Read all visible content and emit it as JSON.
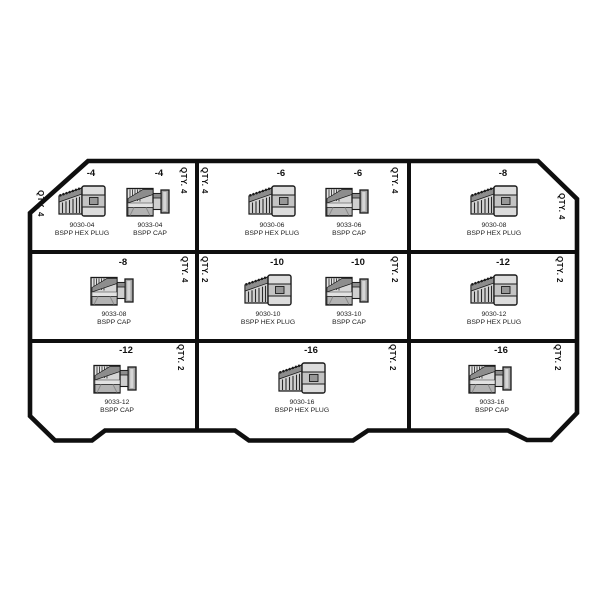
{
  "diagram": {
    "description": "BSPP hex plug and cap kit compartment layout",
    "line_color": "#0f0f0f",
    "background_color": "#ffffff",
    "fill_grays": [
      "#8d8d8d",
      "#b3b3b3",
      "#cfcfcf",
      "#d6d6d6",
      "#e2e2e2"
    ],
    "cells": [
      {
        "position": "row1-col1",
        "qty_left": "QTY. 4",
        "qty_right": "QTY. 4",
        "items": [
          {
            "size": "-4",
            "part": "9030-04",
            "name": "BSPP HEX PLUG",
            "type": "hex plug"
          },
          {
            "size": "-4",
            "part": "9033-04",
            "name": "BSPP CAP",
            "type": "cap"
          }
        ]
      },
      {
        "position": "row1-col2",
        "qty_left": "QTY. 4",
        "qty_right": "QTY. 4",
        "items": [
          {
            "size": "-6",
            "part": "9030-06",
            "name": "BSPP HEX PLUG",
            "type": "hex plug"
          },
          {
            "size": "-6",
            "part": "9033-06",
            "name": "BSPP CAP",
            "type": "cap"
          }
        ]
      },
      {
        "position": "row1-col3",
        "qty_right": "QTY. 4",
        "items": [
          {
            "size": "-8",
            "part": "9030-08",
            "name": "BSPP HEX PLUG",
            "type": "hex plug"
          }
        ]
      },
      {
        "position": "row2-col1",
        "qty_right": "QTY. 4",
        "items": [
          {
            "size": "-8",
            "part": "9033-08",
            "name": "BSPP CAP",
            "type": "cap"
          }
        ]
      },
      {
        "position": "row2-col2",
        "qty_left": "QTY. 2",
        "qty_right": "QTY. 2",
        "items": [
          {
            "size": "-10",
            "part": "9030-10",
            "name": "BSPP HEX PLUG",
            "type": "hex plug"
          },
          {
            "size": "-10",
            "part": "9033-10",
            "name": "BSPP CAP",
            "type": "cap"
          }
        ]
      },
      {
        "position": "row2-col3",
        "qty_right": "QTY. 2",
        "items": [
          {
            "size": "-12",
            "part": "9030-12",
            "name": "BSPP HEX PLUG",
            "type": "hex plug"
          }
        ]
      },
      {
        "position": "row3-col1",
        "qty_right": "QTY. 2",
        "items": [
          {
            "size": "-12",
            "part": "9033-12",
            "name": "BSPP CAP",
            "type": "cap"
          }
        ]
      },
      {
        "position": "row3-col2",
        "qty_right": "QTY. 2",
        "items": [
          {
            "size": "-16",
            "part": "9030-16",
            "name": "BSPP HEX PLUG",
            "type": "hex plug"
          }
        ]
      },
      {
        "position": "row3-col3",
        "qty_right": "QTY. 2",
        "items": [
          {
            "size": "-16",
            "part": "9033-16",
            "name": "BSPP CAP",
            "type": "cap"
          }
        ]
      }
    ]
  }
}
